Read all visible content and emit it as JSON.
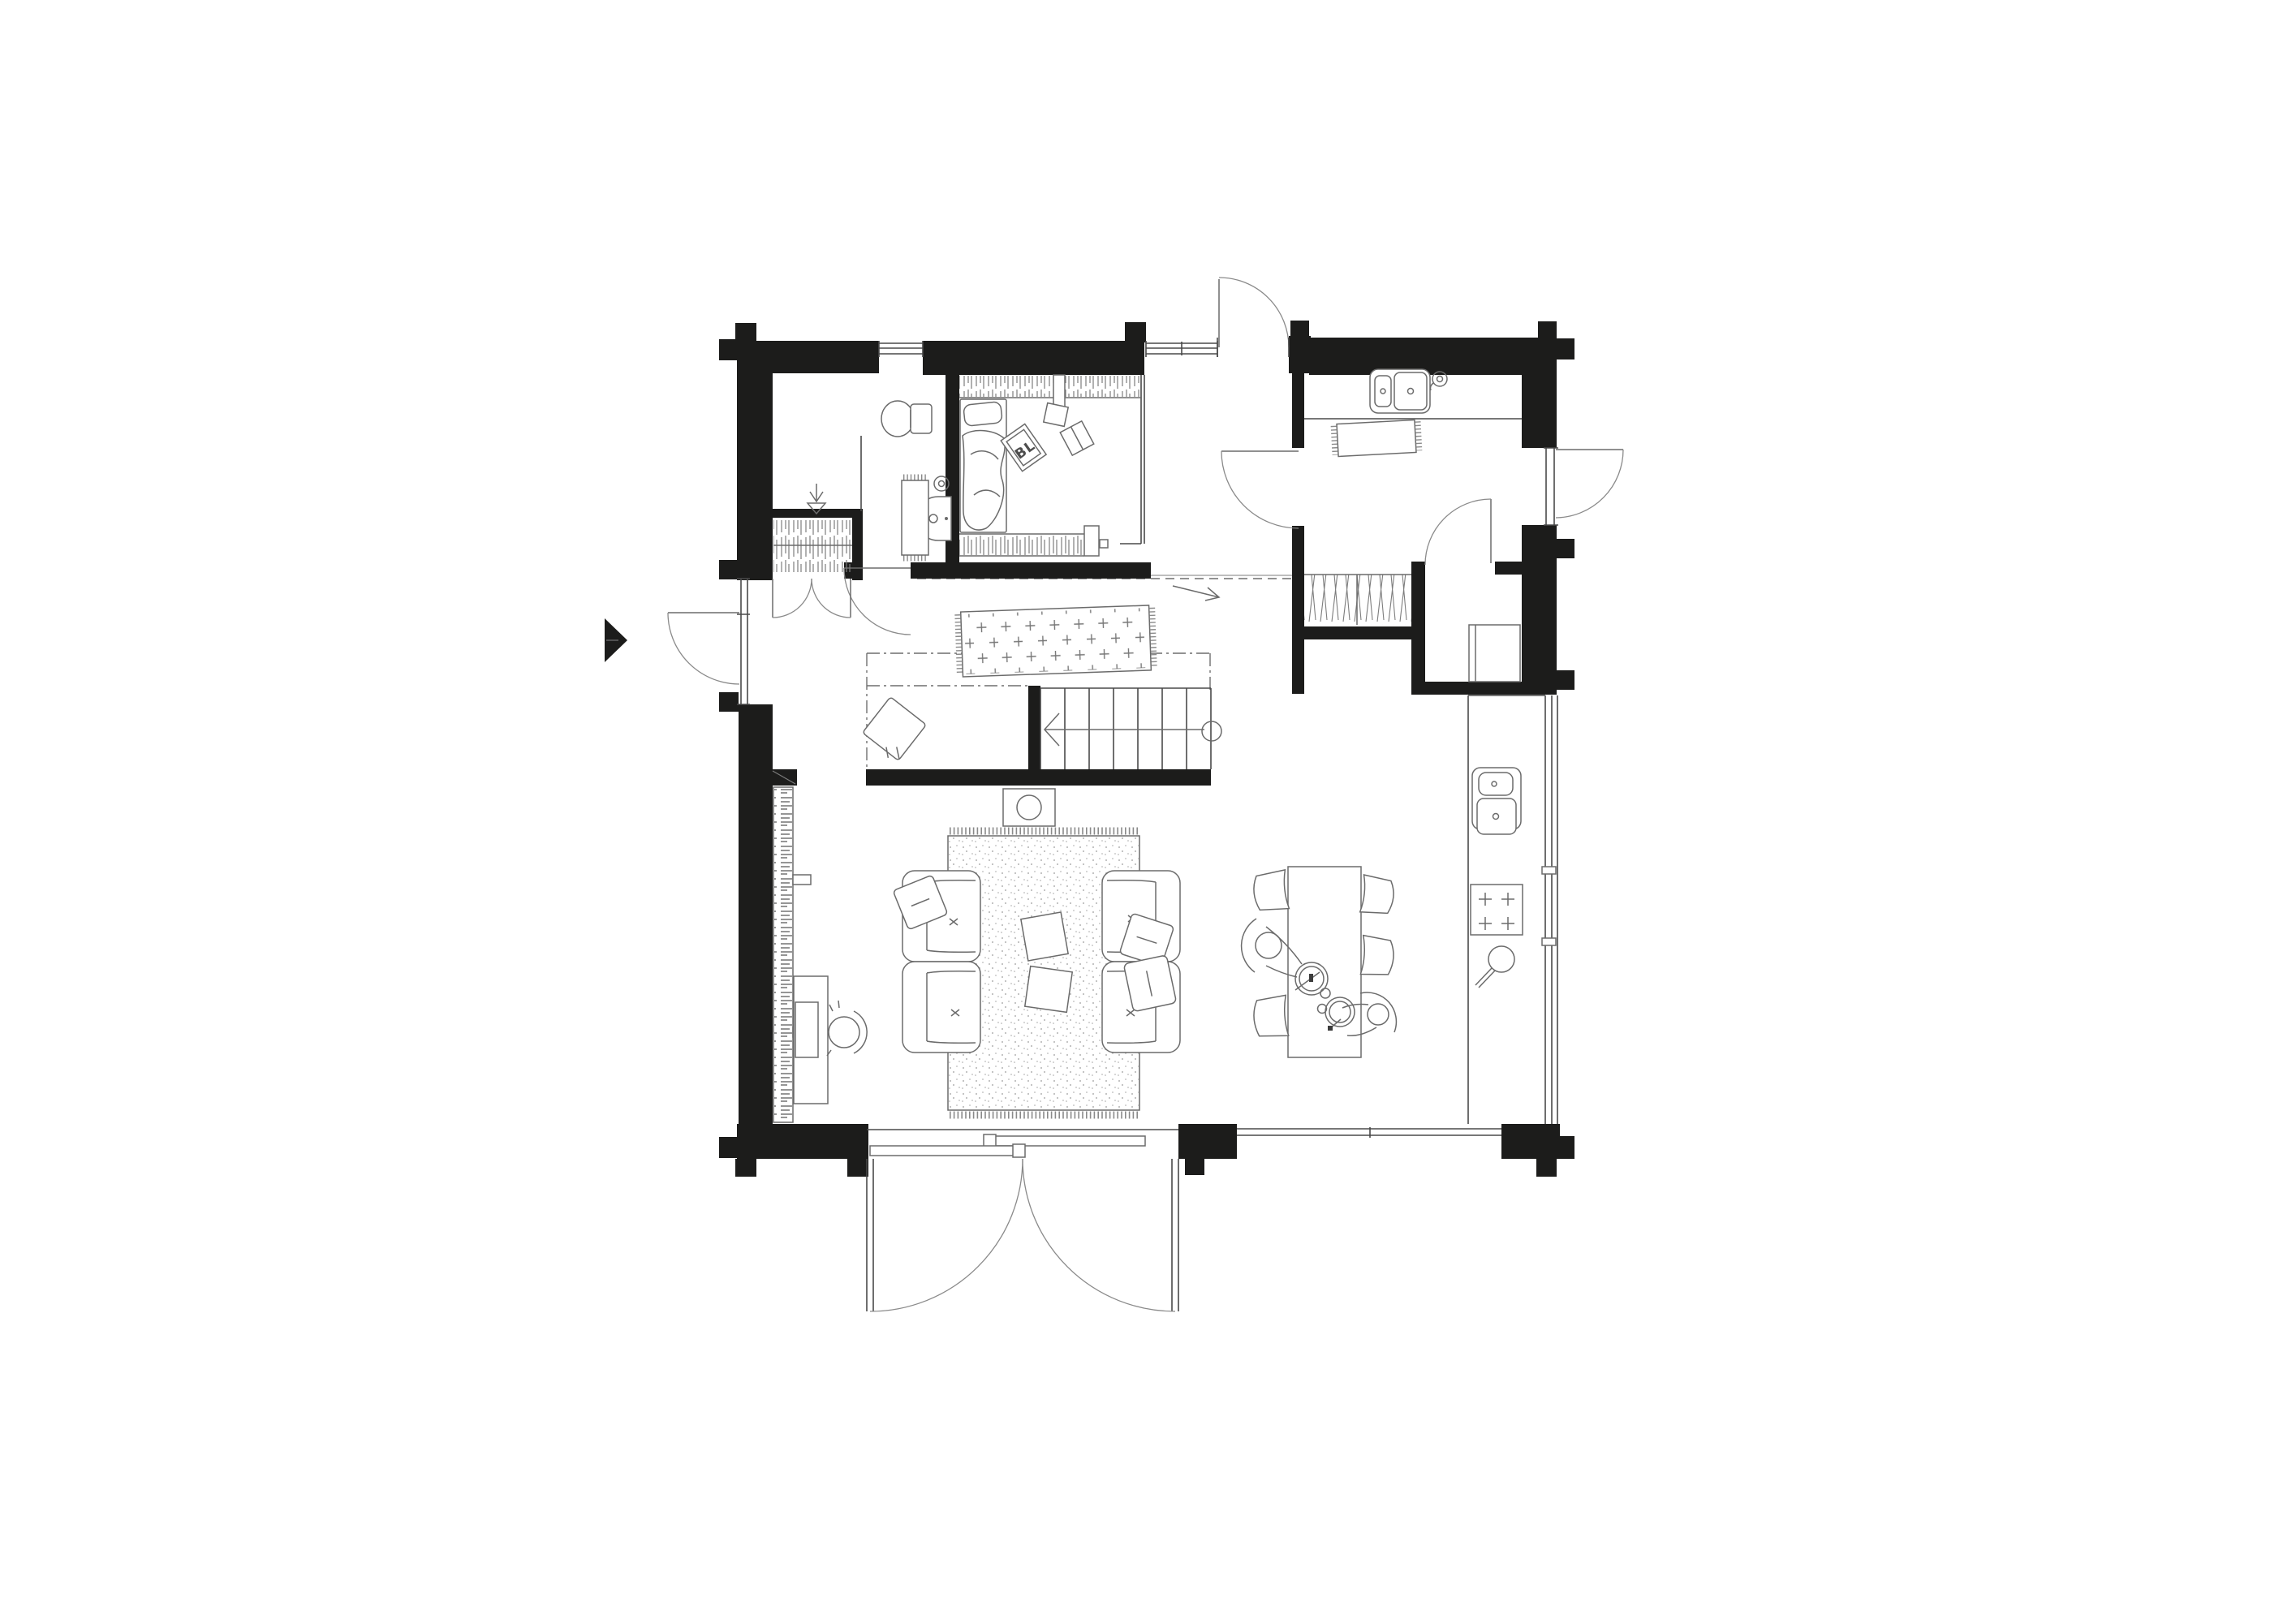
{
  "page": {
    "title": "Floor plan drawing"
  },
  "drawing": {
    "kind": "log-house ground-floor architectural plan, top view, black wall poche with gray line furniture",
    "labels": {
      "magazine": "BL"
    },
    "colors": {
      "wall": "#1c1c1b",
      "furniture_line": "#6b6b6b",
      "structure_line": "#4a4a4a",
      "door_arc": "#8a8a8a",
      "background": "#ffffff"
    }
  }
}
